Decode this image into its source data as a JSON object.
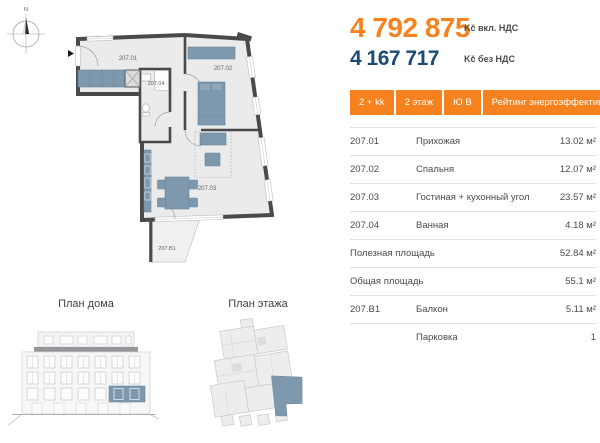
{
  "compass": {
    "north_label": "N"
  },
  "apartment_plan": {
    "rooms": {
      "hallway": "207.01",
      "bedroom": "207.02",
      "living": "207.03",
      "bathroom": "207.04",
      "balcony": "207.B1"
    }
  },
  "sections": {
    "house_plan_title": "План дома",
    "floor_plan_title": "План этажа"
  },
  "pricing": {
    "price_with_vat": "4 792 875",
    "price_with_vat_label": "Kč вкл. НДС",
    "price_without_vat": "4 167 717",
    "price_without_vat_label": "Kč без НДС"
  },
  "badges": [
    {
      "label": "2 + kk"
    },
    {
      "label": "2 этаж"
    },
    {
      "label": "Ю В"
    },
    {
      "label": "Рейтинг энергоэффективности : В"
    }
  ],
  "details_table": {
    "rows": [
      {
        "code": "207.01",
        "name": "Прихожая",
        "value": "13.02 м²"
      },
      {
        "code": "207.02",
        "name": "Спальня",
        "value": "12.07 м²"
      },
      {
        "code": "207.03",
        "name": "Гостиная + кухонный угол",
        "value": "23.57 м²"
      },
      {
        "code": "207.04",
        "name": "Ванная",
        "value": "4.18 м²"
      },
      {
        "code": "Полезная площадь",
        "name": "",
        "value": "52.84 м²"
      },
      {
        "code": "Общая площадь",
        "name": "",
        "value": "55.1 м²"
      },
      {
        "code": "207.B1",
        "name": "Балкон",
        "value": "5.11 м²"
      },
      {
        "code": "",
        "name": "Парковка",
        "value": "1"
      }
    ]
  },
  "colors": {
    "accent_orange": "#F5821F",
    "price_navy": "#1B4B73",
    "plan_wall": "#4A4A4C",
    "plan_floor": "#EBEBEB",
    "furniture_blue": "#7E99AD",
    "highlight_blue": "#7E99AD",
    "divider_gray": "#E0E0E0"
  }
}
